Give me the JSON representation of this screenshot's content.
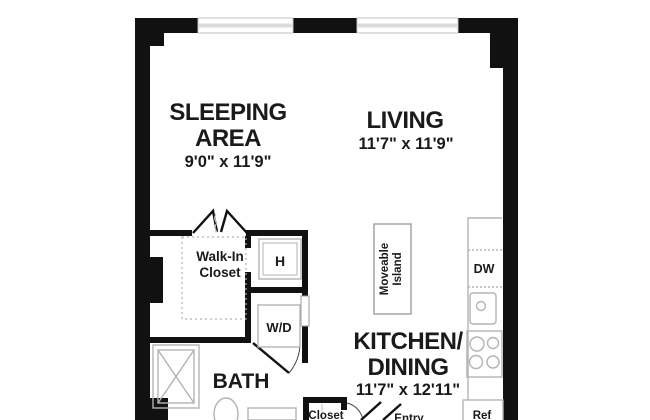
{
  "plan": {
    "colors": {
      "wall": "#111111",
      "fixture": "#b3b3b3",
      "counter": "#9e9e9e",
      "text": "#1a1a1a",
      "background": "#ffffff"
    },
    "rooms": {
      "sleeping_area": {
        "label_line1": "SLEEPING",
        "label_line2": "AREA",
        "dimensions": "9'0\" x 11'9\""
      },
      "living": {
        "label": "LIVING",
        "dimensions": "11'7\" x 11'9\""
      },
      "kitchen_dining": {
        "label_line1": "KITCHEN/",
        "label_line2": "DINING",
        "dimensions": "11'7\" x 12'11\""
      },
      "bath": {
        "label": "BATH"
      },
      "walk_in_closet": {
        "label_line1": "Walk-In",
        "label_line2": "Closet"
      },
      "entry_closet": {
        "label": "Closet"
      },
      "entry": {
        "label": "Entry"
      }
    },
    "fixtures": {
      "heater": "H",
      "washer_dryer": "W/D",
      "dishwasher": "DW",
      "refrigerator": "Ref",
      "island_line1": "Moveable",
      "island_line2": "Island"
    }
  }
}
